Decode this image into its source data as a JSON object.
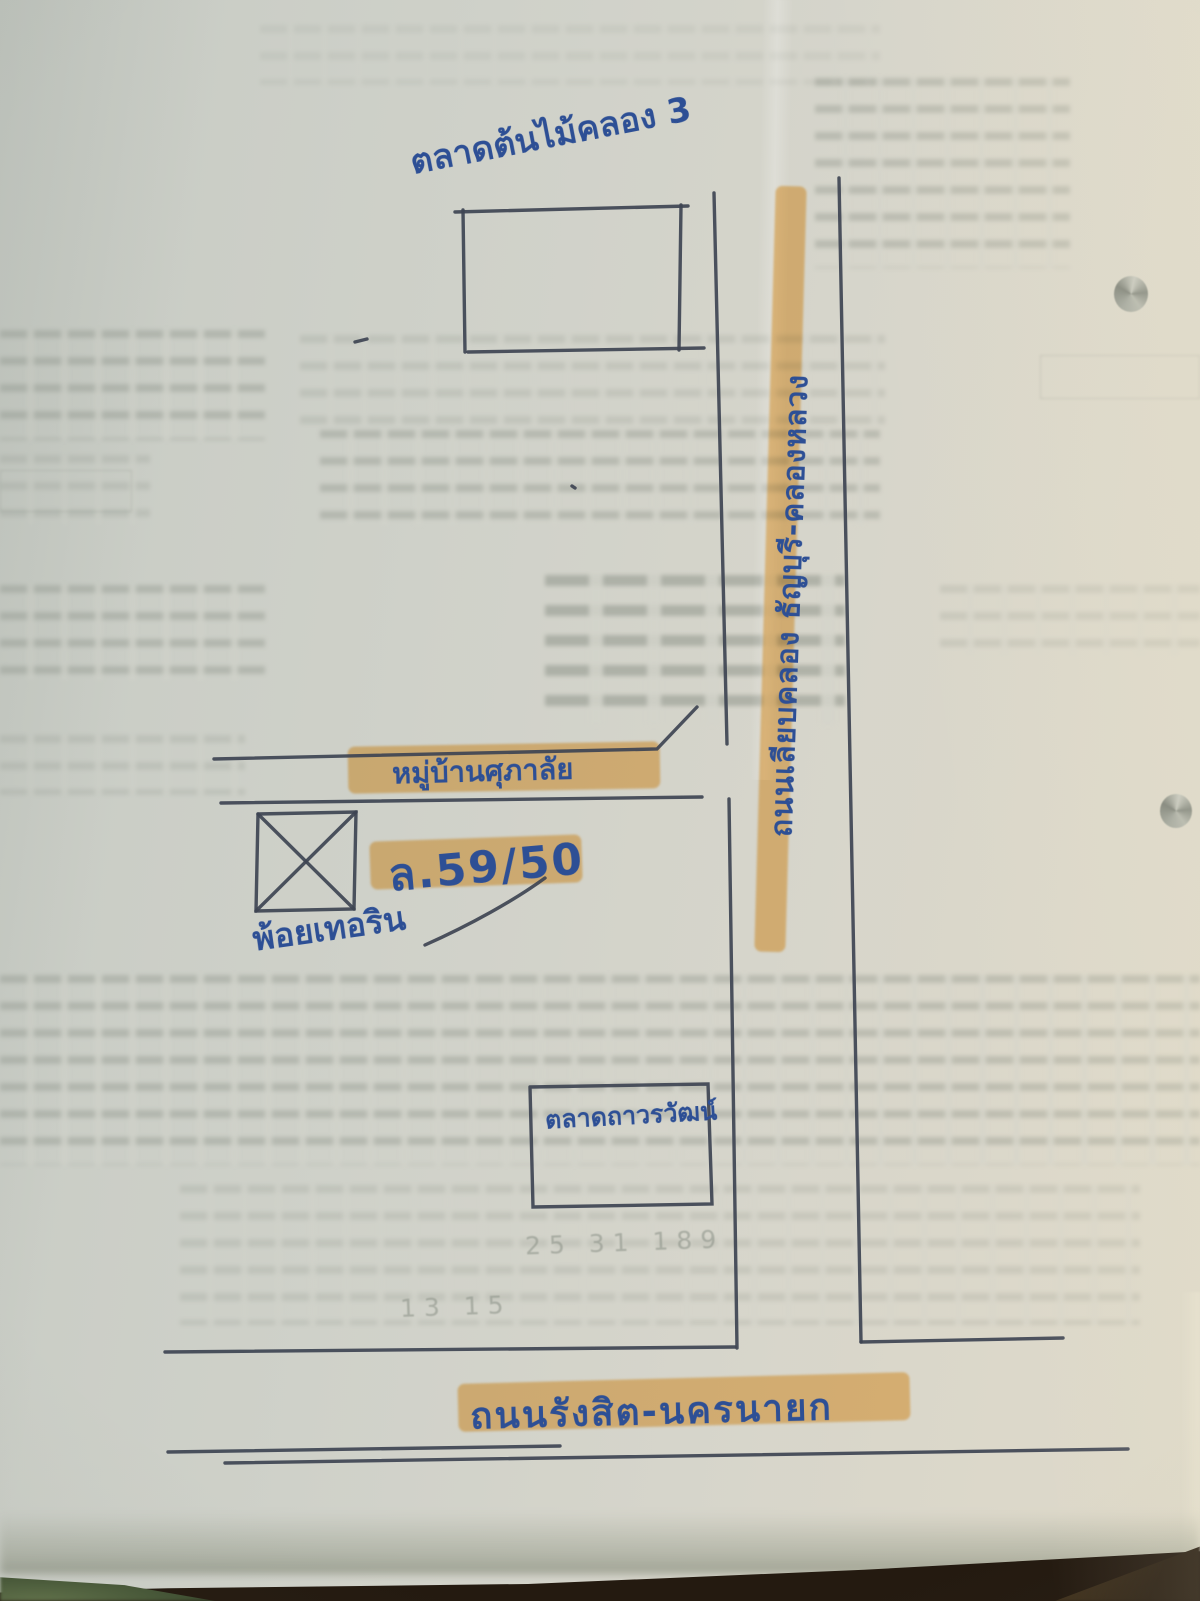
{
  "map": {
    "top_market": {
      "label": "ตลาดต้นไม้คลอง 3"
    },
    "vertical_road": {
      "label": "ถนนเลียบคลอง ธัญบุรี-คลองหลวง"
    },
    "soi": {
      "label": "หมู่บ้านศุภาลัย"
    },
    "plot": {
      "label": "ล.59/50"
    },
    "site": {
      "label": "พ้อยเทอริน"
    },
    "lower_market": {
      "label": "ตลาดถาวรวัฒน์"
    },
    "bottom_road": {
      "label": "ถนนรังสิต-นครนายก"
    }
  },
  "faint_marks": {
    "pencil_numbers_1": "25   31   189",
    "pencil_numbers_2": "13   15"
  },
  "colors": {
    "highlighter_orange": "#F3A93C",
    "ink_blue": "#2D4F95",
    "pen_gray": "#3E4452",
    "paper": "#D2D3CA",
    "background_dark": "#241A10"
  }
}
